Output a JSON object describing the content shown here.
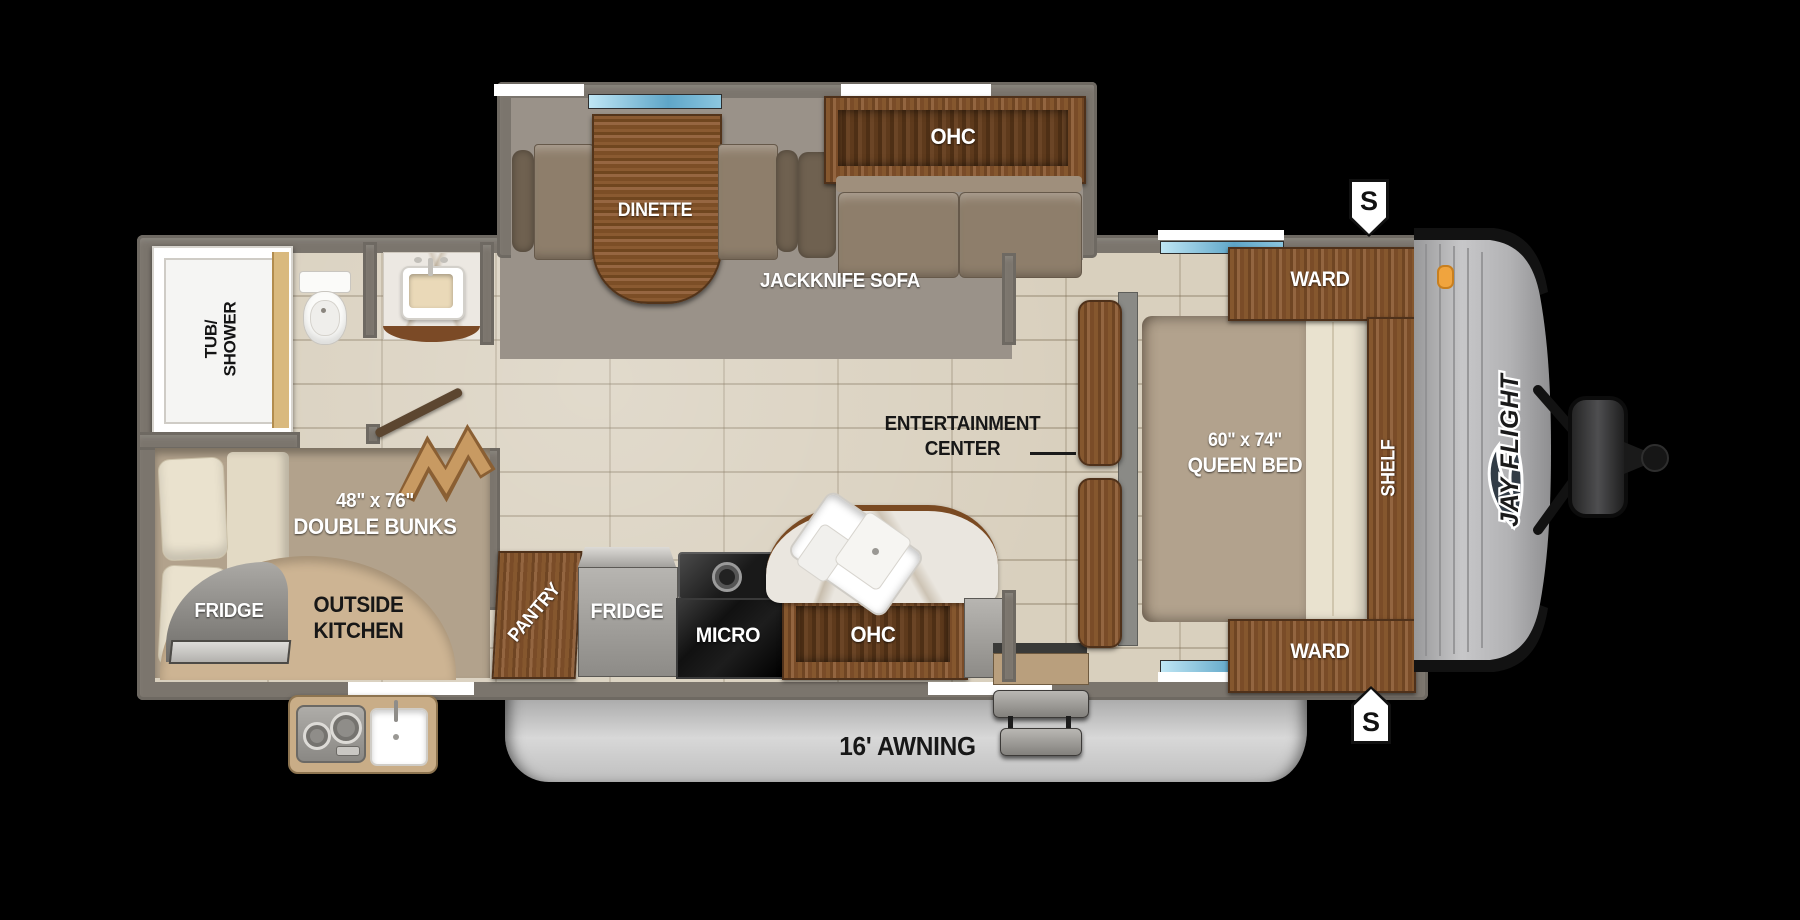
{
  "colors": {
    "background": "#000000",
    "wall_gray": "#7b756d",
    "tile_floor": "#d9d0be",
    "slide_floor": "#9a9289",
    "wood_brown": "#7a4c28",
    "upholstery_tan": "#8e7e6b",
    "outside_kitchen_tan": "#cdb493",
    "awning_gray": "#c6c6c6",
    "window_blue": "#5fa6c8",
    "marker_orange": "#f0a43e"
  },
  "labels": {
    "dinette": "DINETTE",
    "ohc_top": "OHC",
    "jackknife_sofa": "JACKKNIFE SOFA",
    "tub_line1": "TUB/",
    "tub_line2": "SHOWER",
    "bunks_size": "48\" x 76\"",
    "bunks_name": "DOUBLE BUNKS",
    "fridge_outside": "FRIDGE",
    "outside_kitchen_line1": "OUTSIDE",
    "outside_kitchen_line2": "KITCHEN",
    "pantry": "PANTRY",
    "fridge_main": "FRIDGE",
    "micro": "MICRO",
    "ohc_bottom": "OHC",
    "entertainment_line1": "ENTERTAINMENT",
    "entertainment_line2": "CENTER",
    "queen_size": "60\" x 74\"",
    "queen_name": "QUEEN BED",
    "ward_top": "WARD",
    "ward_bottom": "WARD",
    "shelf": "SHELF",
    "awning": "16' AWNING",
    "speaker_top": "S",
    "speaker_bottom": "S",
    "brand_logo": "JAY FLIGHT"
  }
}
